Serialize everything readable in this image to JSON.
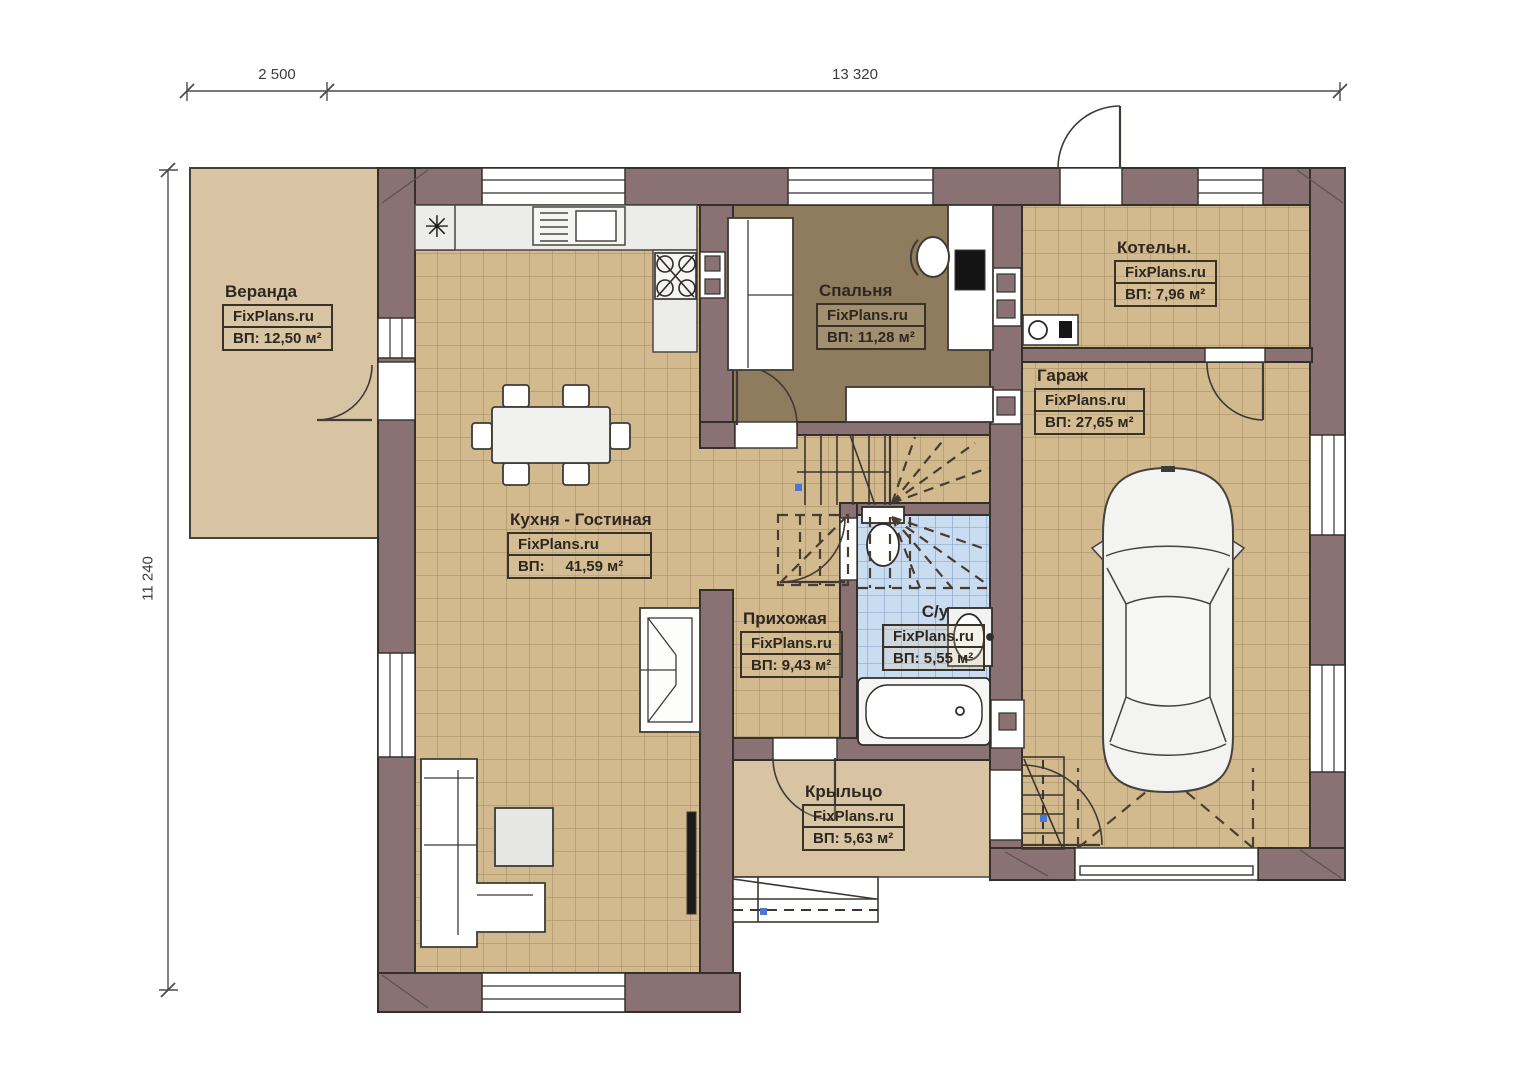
{
  "brand": "FixPlans.ru",
  "dimensions": {
    "top_left": "2 500",
    "top_right": "13 320",
    "left": "11 240"
  },
  "rooms": [
    {
      "id": "veranda",
      "name": "Веранда",
      "brand": "FixPlans.ru",
      "area": "ВП: 12,50 м²"
    },
    {
      "id": "kitchen_living",
      "name": "Кухня - Гостиная",
      "brand": "FixPlans.ru",
      "area": "ВП:     41,59 м²"
    },
    {
      "id": "bedroom",
      "name": "Спальня",
      "brand": "FixPlans.ru",
      "area": "ВП: 11,28 м²"
    },
    {
      "id": "boiler",
      "name": "Котельн.",
      "brand": "FixPlans.ru",
      "area": "ВП: 7,96 м²"
    },
    {
      "id": "garage",
      "name": "Гараж",
      "brand": "FixPlans.ru",
      "area": "ВП: 27,65 м²"
    },
    {
      "id": "hallway",
      "name": "Прихожая",
      "brand": "FixPlans.ru",
      "area": "ВП: 9,43 м²"
    },
    {
      "id": "bathroom",
      "name": "С/у",
      "brand": "FixPlans.ru",
      "area": "ВП: 5,55 м²"
    },
    {
      "id": "porch",
      "name": "Крыльцо",
      "brand": "FixPlans.ru",
      "area": "ВП: 5,63 м²"
    }
  ],
  "icons": {
    "fridge_symbol": "✳"
  },
  "colors": {
    "wall": "#8a7174",
    "tile": "#d3b98e",
    "tile_line": "#a8906a",
    "bath_tile": "#cadcf0",
    "bath_tile_line": "#7f9cc4",
    "bedroom_floor": "#8f7c5f",
    "veranda": "#d8c4a3",
    "accent_dot": "#4a78d0"
  }
}
